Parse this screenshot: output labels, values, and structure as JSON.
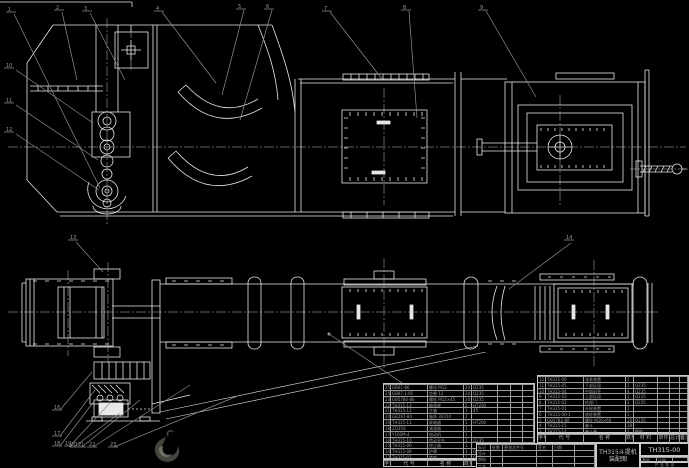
{
  "drawing": {
    "background_color": "#000000",
    "line_color": "#e8e8e8",
    "leader_color": "#8f8f8f",
    "description": "TH315 bucket elevator assembly drawing, front view above, plan view below"
  },
  "title_block": {
    "product_name": "TH315斗提机",
    "sheet_name": "装配图",
    "drawing_number": "TH315-00",
    "weight_label": "重量",
    "scale_label": "比例",
    "sheet_label": "共 张 第 张",
    "info": [
      [
        "重量",
        "比例",
        ""
      ]
    ],
    "sig": [
      [
        "标记",
        "处数",
        "更改文件号",
        "签名",
        "日期",
        ""
      ],
      [
        "设计",
        "",
        "",
        "",
        "",
        ""
      ],
      [
        "审核",
        "",
        "",
        "",
        "",
        ""
      ],
      [
        "工艺",
        "",
        "",
        "",
        "",
        ""
      ]
    ]
  },
  "bom_left": {
    "header": [
      [
        "序号",
        "代  号",
        "名  称",
        "数量",
        "材 料",
        "单件",
        "总计",
        "备注"
      ]
    ],
    "rows": [
      [
        "25",
        "GB41-86",
        "螺母 M12",
        "24",
        "Q235",
        "",
        "",
        ""
      ],
      [
        "24",
        "GB97.1-85",
        "垫圈 12",
        "24",
        "Q235",
        "",
        "",
        ""
      ],
      [
        "23",
        "GB5780-86",
        "螺栓 M12×45",
        "24",
        "Q235",
        "",
        "",
        ""
      ],
      [
        "22",
        "TH315-13",
        "轴承座",
        "2",
        "HT200",
        "",
        "",
        ""
      ],
      [
        "21",
        "TH315-12",
        "主轴",
        "1",
        "45",
        "",
        "",
        ""
      ],
      [
        "20",
        "GB297-84",
        "轴承 30310",
        "2",
        "",
        "",
        "",
        ""
      ],
      [
        "19",
        "TH315-11",
        "联轴器",
        "1",
        "HT200",
        "",
        "",
        ""
      ],
      [
        "18",
        "ZQ350",
        "减速器",
        "1",
        "",
        "",
        "",
        ""
      ],
      [
        "17",
        "Y160M-4",
        "电动机",
        "1",
        "",
        "",
        "",
        ""
      ],
      [
        "16",
        "TH315-10",
        "传动平台",
        "1",
        "Q235",
        "",
        "",
        ""
      ],
      [
        "15",
        "TH315-09",
        "逆止器",
        "1",
        "",
        "",
        "",
        ""
      ],
      [
        "14",
        "TH315-08",
        "护罩",
        "1",
        "Q235",
        "",
        "",
        ""
      ],
      [
        "13",
        "TH315-07",
        "底座",
        "1",
        "Q235",
        "",
        "",
        ""
      ]
    ]
  },
  "bom_right": {
    "header": [
      [
        "序号",
        "代  号",
        "名  称",
        "数量",
        "材 料",
        "单件",
        "总计",
        "备注"
      ]
    ],
    "rows": [
      [
        "12",
        "TH315-06",
        "张紧装置",
        "1",
        "",
        "",
        "",
        ""
      ],
      [
        "11",
        "TH315-05",
        "下部区段",
        "1",
        "Q235",
        "",
        "",
        ""
      ],
      [
        "10",
        "TH315-04",
        "中部机壳",
        "4",
        "Q235",
        "",
        "",
        ""
      ],
      [
        "9",
        "TH315-03",
        "上部区段",
        "1",
        "Q235",
        "",
        "",
        ""
      ],
      [
        "8",
        "TH315-02",
        "检视门",
        "2",
        "Q235",
        "",
        "",
        ""
      ],
      [
        "7",
        "TH315-01",
        "头轮装置",
        "1",
        "",
        "",
        "",
        ""
      ],
      [
        "6",
        "TH315-00-1",
        "底轮装置",
        "1",
        "",
        "",
        "",
        ""
      ],
      [
        "5",
        "GB5782-86",
        "螺栓 M16×60",
        "16",
        "Q235",
        "",
        "",
        ""
      ],
      [
        "4",
        "TH315-15",
        "畚斗",
        "38",
        "",
        "",
        "",
        ""
      ],
      [
        "3",
        "TH315-14",
        "畚斗带",
        "1",
        "橡胶",
        "",
        "",
        ""
      ]
    ]
  },
  "callouts": [
    "1",
    "2",
    "3",
    "4",
    "5",
    "6",
    "7",
    "8",
    "9",
    "10",
    "11",
    "12",
    "13",
    "14",
    "16",
    "17",
    "18",
    "19",
    "20",
    "21",
    "22",
    "23"
  ]
}
